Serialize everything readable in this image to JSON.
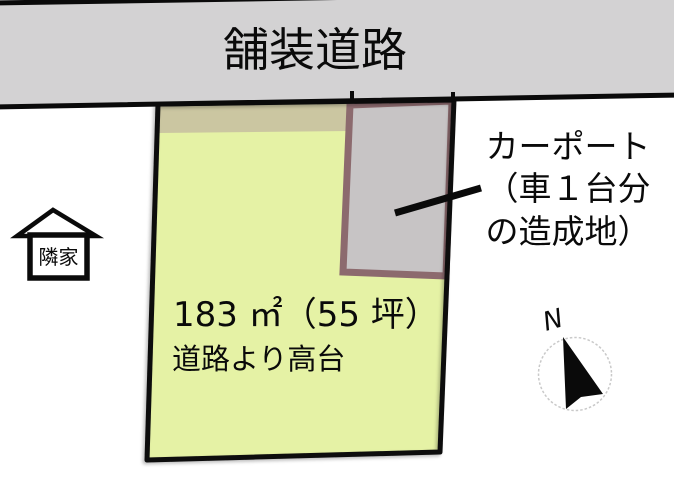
{
  "road": {
    "label": "舗装道路"
  },
  "site": {
    "area_label": "183 ㎡（55 坪）",
    "note_label": "道路より高台"
  },
  "carport": {
    "lines": [
      "カーポート",
      "（車１台分",
      "の造成地）"
    ]
  },
  "neighbor_house": {
    "label": "隣家"
  },
  "compass": {
    "north_label": "N"
  },
  "colors": {
    "road_fill": "#d3d2d3",
    "plot_fill": "#e5f2a5",
    "strip_fill": "#cbc6a1",
    "carport_fill": "#c7c4c5",
    "carport_border": "#8c6a6e",
    "outline": "#0a0a0a",
    "compass_circle": "#c9c9c9"
  }
}
